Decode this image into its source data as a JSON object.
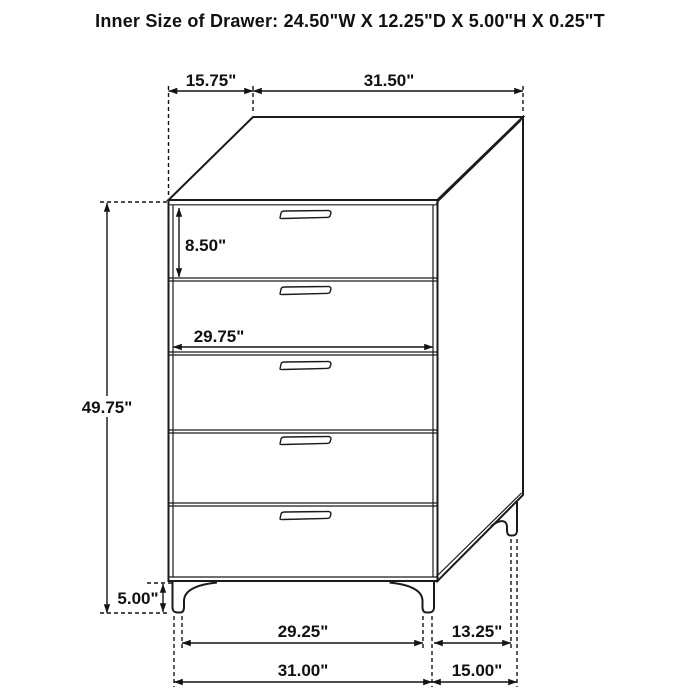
{
  "header": {
    "title": "Inner Size of Drawer: 24.50\"W X 12.25\"D X 5.00\"H X 0.25\"T"
  },
  "figure": {
    "description": "Five-drawer chest, oblique line drawing with dimension callouts",
    "drawer_count": 5,
    "colors": {
      "line": "#1b1b1b",
      "background": "#ffffff"
    }
  },
  "dims": {
    "top_depth": "15.75\"",
    "top_width": "31.50\"",
    "drawer_height": "8.50\"",
    "drawer_width": "29.75\"",
    "overall_height": "49.75\"",
    "leg_height": "5.00\"",
    "foot_span_width": "29.25\"",
    "foot_span_depth": "13.25\"",
    "base_width": "31.00\"",
    "base_depth": "15.00\""
  }
}
